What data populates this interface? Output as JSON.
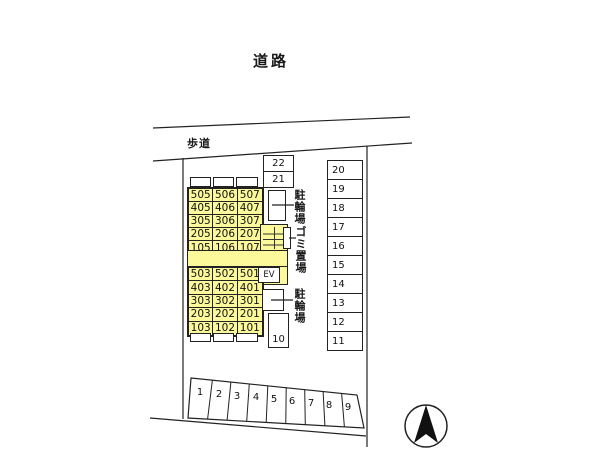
{
  "labels": {
    "road": "道路",
    "sidewalk": "歩道",
    "bike_parking_upper": "駐輪場",
    "garbage_area": "ゴミ置場",
    "bike_parking_lower": "駐輪場",
    "elevator": "EV"
  },
  "building": {
    "upper_rooms": [
      [
        "505",
        "506",
        "507"
      ],
      [
        "405",
        "406",
        "407"
      ],
      [
        "305",
        "306",
        "307"
      ],
      [
        "205",
        "206",
        "207"
      ],
      [
        "105",
        "106",
        "107"
      ]
    ],
    "lower_rooms": [
      [
        "503",
        "502",
        "501"
      ],
      [
        "403",
        "402",
        "401"
      ],
      [
        "303",
        "302",
        "301"
      ],
      [
        "203",
        "202",
        "201"
      ],
      [
        "103",
        "102",
        "101"
      ]
    ]
  },
  "parking": {
    "top_spaces": [
      "22",
      "21"
    ],
    "right_spaces": [
      "20",
      "19",
      "18",
      "17",
      "16",
      "15",
      "14",
      "13",
      "12",
      "11"
    ],
    "middle_space": "10",
    "bottom_spaces": [
      "1",
      "2",
      "3",
      "4",
      "5",
      "6",
      "7",
      "8",
      "9"
    ]
  },
  "colors": {
    "building_fill": "#fcf99b",
    "line": "#222222",
    "background": "#ffffff",
    "compass_arrow": "#111111"
  }
}
